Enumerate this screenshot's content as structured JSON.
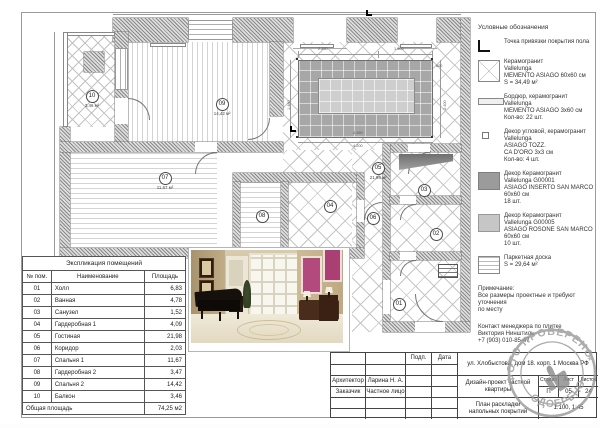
{
  "legend": {
    "title": "Условные обозначения",
    "items": [
      {
        "icon": "anchor-icon",
        "text": "Точка привязки покрытия пола"
      },
      {
        "icon": "tile-x-swatch",
        "text": "Керамогранит\nVallelunga\nMEMENTO ASIAGO 60x60 см\nS = 34,49 м²"
      },
      {
        "icon": "border-swatch",
        "text": "Бордюр, керамогранит\nVallelunga\nMEMENTO ASIAGO 3x60 см\nКол-во: 22 шт."
      },
      {
        "icon": "corner-decor-swatch",
        "text": "Декор угловой, керамогранит\nVallelunga\nASIAGO TOZZ.\nCA D'ORO 3x3 см\nКол-во: 4 шт."
      },
      {
        "icon": "dark-swatch",
        "text": "Декор Керамогранит\nVallelunga G00001\nASIAGO INSERTO SAN MARCO\n60x60 см\n18 шт."
      },
      {
        "icon": "light-swatch",
        "text": "Декор Керамогранит\nVallelunga G00005\nASIAGO ROSONE SAN MARCO\n60x60 см\n10 шт."
      },
      {
        "icon": "parquet-swatch",
        "text": "Паркетная доска\nS = 29,64 м²"
      }
    ],
    "note": "Примечание:\nВсе размеры проектные и требуют уточнения\nпо месту",
    "contact": "Контакт менеджера по плитке\nВиктория Нинштиль\n+7 (903) 010-85-47"
  },
  "explication": {
    "title": "Экспликация помещений",
    "headers": {
      "num": "№ пом.",
      "name": "Наименование",
      "area": "Площадь"
    },
    "rows": [
      {
        "num": "01",
        "name": "Холл",
        "area": "6,83"
      },
      {
        "num": "02",
        "name": "Ванная",
        "area": "4,78"
      },
      {
        "num": "03",
        "name": "Санузел",
        "area": "1,52"
      },
      {
        "num": "04",
        "name": "Гардеробная 1",
        "area": "4,09"
      },
      {
        "num": "05",
        "name": "Гостиная",
        "area": "21,98"
      },
      {
        "num": "06",
        "name": "Коридор",
        "area": "2,03"
      },
      {
        "num": "07",
        "name": "Спальня 1",
        "area": "11,67"
      },
      {
        "num": "08",
        "name": "Гардеробная 2",
        "area": "3,47"
      },
      {
        "num": "09",
        "name": "Спальня 2",
        "area": "14,42"
      },
      {
        "num": "10",
        "name": "Балкон",
        "area": "3,46"
      }
    ],
    "total_label": "Общая площадь",
    "total_value": "74,25 м2"
  },
  "titleblock": {
    "podp": "Подп.",
    "date": "Дата",
    "architect_label": "Архитектор",
    "architect": "Ларина Н. А.",
    "client_label": "Заказчик",
    "client": "Частное лицо",
    "address": "ул. Хлобыстова, дом 18. корп. 1 Москва РФ",
    "project": "Дизайн-проект частной квартиры",
    "sheet_title": "План раскладки напольных покрытий",
    "stage_label": "Стадия",
    "stage": "П",
    "sheet_label": "Лист",
    "sheet": "05",
    "sheets_label": "Листов",
    "sheets": "24",
    "scale": "1:100, 1:45"
  },
  "stamp": {
    "top": "ФОТО ПРОВЕРЕНО",
    "bottom": "ОДОБРЕНО"
  },
  "plan": {
    "rooms": [
      {
        "num": "10",
        "area": "3,46 м²",
        "x": 77,
        "y": 84
      },
      {
        "num": "09",
        "area": "14,42 м²",
        "x": 207,
        "y": 92
      },
      {
        "num": "05",
        "area": "21,98 м²",
        "x": 363,
        "y": 156
      },
      {
        "num": "07",
        "area": "11,67 м²",
        "x": 150,
        "y": 166
      },
      {
        "num": "08",
        "area": "",
        "x": 247,
        "y": 204
      },
      {
        "num": "04",
        "area": "",
        "x": 315,
        "y": 194
      },
      {
        "num": "06",
        "area": "",
        "x": 358,
        "y": 206
      },
      {
        "num": "03",
        "area": "",
        "x": 409,
        "y": 178
      },
      {
        "num": "02",
        "area": "",
        "x": 421,
        "y": 222
      },
      {
        "num": "01",
        "area": "",
        "x": 384,
        "y": 292
      }
    ],
    "dims": [
      {
        "t": "2.250",
        "x": 318,
        "y": 47,
        "cls": "h"
      },
      {
        "t": "1.500",
        "x": 394,
        "y": 47,
        "cls": "h"
      },
      {
        "t": "600",
        "x": 436,
        "y": 64,
        "cls": "h"
      },
      {
        "t": "4.260",
        "x": 353,
        "y": 131,
        "cls": "h"
      },
      {
        "t": "4.200",
        "x": 353,
        "y": 144,
        "cls": "h"
      },
      {
        "t": "2.400",
        "x": 443,
        "y": 110,
        "cls": "v"
      },
      {
        "t": "1.480",
        "x": 287,
        "y": 110,
        "cls": "v"
      }
    ]
  },
  "colors": {
    "accent_magenta": "#b24a7d",
    "carpet_dark": "#a7a7a7",
    "carpet_light": "#cecece",
    "stamp_gray": "#9a9a9a"
  }
}
